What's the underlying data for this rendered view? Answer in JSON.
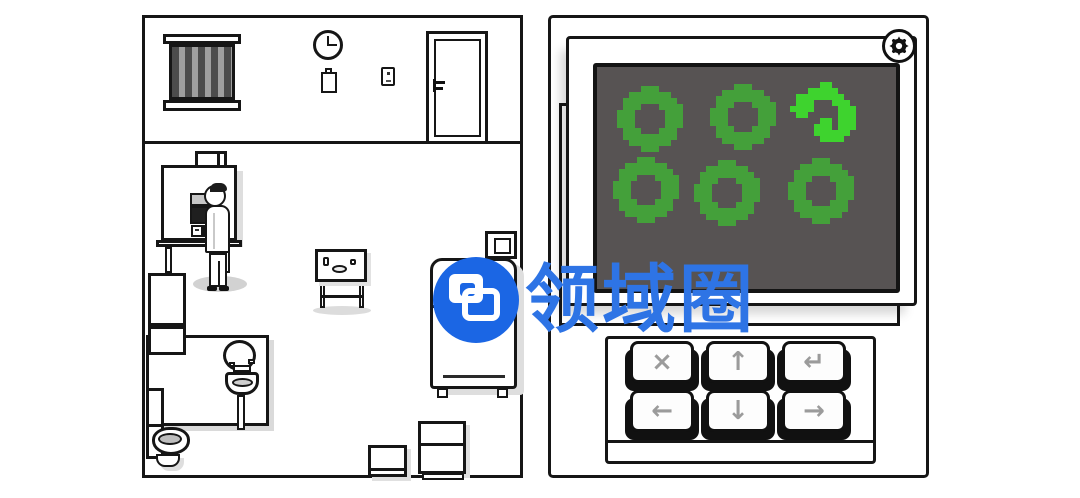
{
  "watermark": {
    "text": "领域圈",
    "logo_color": "#1b66e4",
    "text_color": "#2e74e5"
  },
  "left_room": {
    "clock_time": "3:00",
    "objects": [
      "barred-window",
      "wall-clock",
      "notepad",
      "light-switch",
      "door",
      "workstation",
      "carton-box",
      "character",
      "fridge",
      "bathroom-wall",
      "mirror",
      "sink",
      "toilet",
      "side-table",
      "washing-machine",
      "carton-box-small",
      "carton-box-large"
    ]
  },
  "right_panel": {
    "settings_icon": "gear",
    "screen": {
      "bg": "#575353",
      "border": "#141414"
    },
    "rings": {
      "cell": 6,
      "default_color": "#44a03a",
      "active_color": "#3ed32e",
      "items": [
        {
          "x": 20,
          "y": 19,
          "shape": "full",
          "state": "idle"
        },
        {
          "x": 113,
          "y": 17,
          "shape": "full",
          "state": "idle"
        },
        {
          "x": 193,
          "y": 15,
          "shape": "broken",
          "state": "active"
        },
        {
          "x": 16,
          "y": 90,
          "shape": "full",
          "state": "idle"
        },
        {
          "x": 97,
          "y": 93,
          "shape": "full",
          "state": "idle"
        },
        {
          "x": 191,
          "y": 91,
          "shape": "full",
          "state": "idle"
        }
      ],
      "shapes": {
        "full": [
          "....XXX....",
          "..XXXXXXX..",
          ".XXXXXXXXX.",
          ".XXX...XXXX",
          "XXX.....XXX",
          "XXX.....XXX",
          "XXX.....XXX",
          ".XXX...XXX.",
          ".XXXXXXXXX.",
          "..XXXXXXX..",
          "....XXX...."
        ],
        "broken": [
          ".....XX....",
          "...XXXXX...",
          ".XXXXXXXX..",
          ".XXX...XXX.",
          "XXXX....XXX",
          ".XX.....XXX",
          ".....XX.XXX",
          "....XXX.XXX",
          "....XXXXXX.",
          ".....XXXX..",
          "..........."
        ]
      }
    },
    "keypad": {
      "keys": [
        {
          "id": "cancel",
          "glyph": "×"
        },
        {
          "id": "up",
          "glyph": "↑"
        },
        {
          "id": "enter",
          "glyph": "↵"
        },
        {
          "id": "left",
          "glyph": "←"
        },
        {
          "id": "down",
          "glyph": "↓"
        },
        {
          "id": "right",
          "glyph": "→"
        }
      ]
    }
  }
}
